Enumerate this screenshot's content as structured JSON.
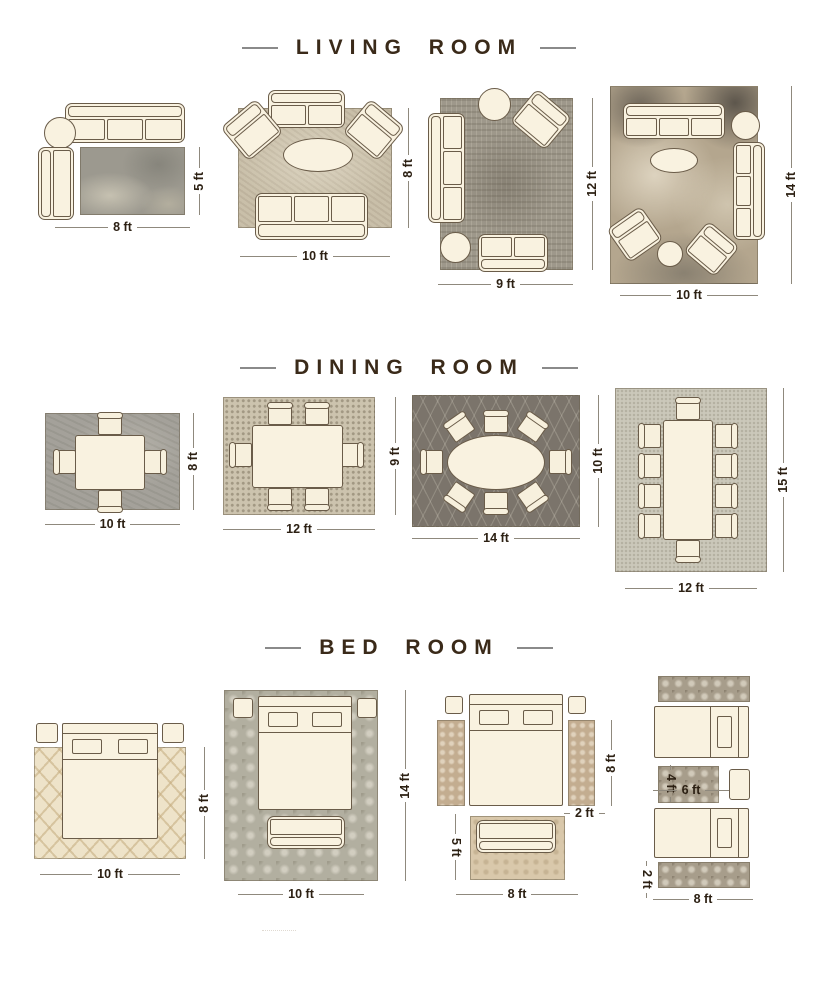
{
  "sections": {
    "living": {
      "title": "LIVING ROOM",
      "layouts": [
        {
          "w": "8 ft",
          "h": "5 ft"
        },
        {
          "w": "10 ft",
          "h": "8 ft"
        },
        {
          "w": "9 ft",
          "h": "12 ft"
        },
        {
          "w": "10 ft",
          "h": "14 ft"
        }
      ]
    },
    "dining": {
      "title": "DINING ROOM",
      "layouts": [
        {
          "w": "10 ft",
          "h": "8 ft"
        },
        {
          "w": "12 ft",
          "h": "9 ft"
        },
        {
          "w": "14 ft",
          "h": "10 ft"
        },
        {
          "w": "12 ft",
          "h": "15 ft"
        }
      ]
    },
    "bed": {
      "title": "BED ROOM",
      "layouts": [
        {
          "w": "10 ft",
          "h": "8 ft"
        },
        {
          "w": "10 ft",
          "h": "14 ft"
        },
        {
          "w": "8 ft",
          "h": "5 ft",
          "runner_h": "8 ft",
          "runner_w": "2 ft"
        },
        {
          "w": "8 ft",
          "mid_w": "6 ft",
          "mid_h": "4 ft",
          "runner_h": "2 ft"
        }
      ]
    }
  },
  "colors": {
    "title_text": "#3a2a19",
    "dimension_text": "#2c2013",
    "dimension_line": "#8f897d",
    "furniture_fill": "#f9f2e0",
    "furniture_outline": "#6a5c49",
    "background": "#ffffff"
  }
}
